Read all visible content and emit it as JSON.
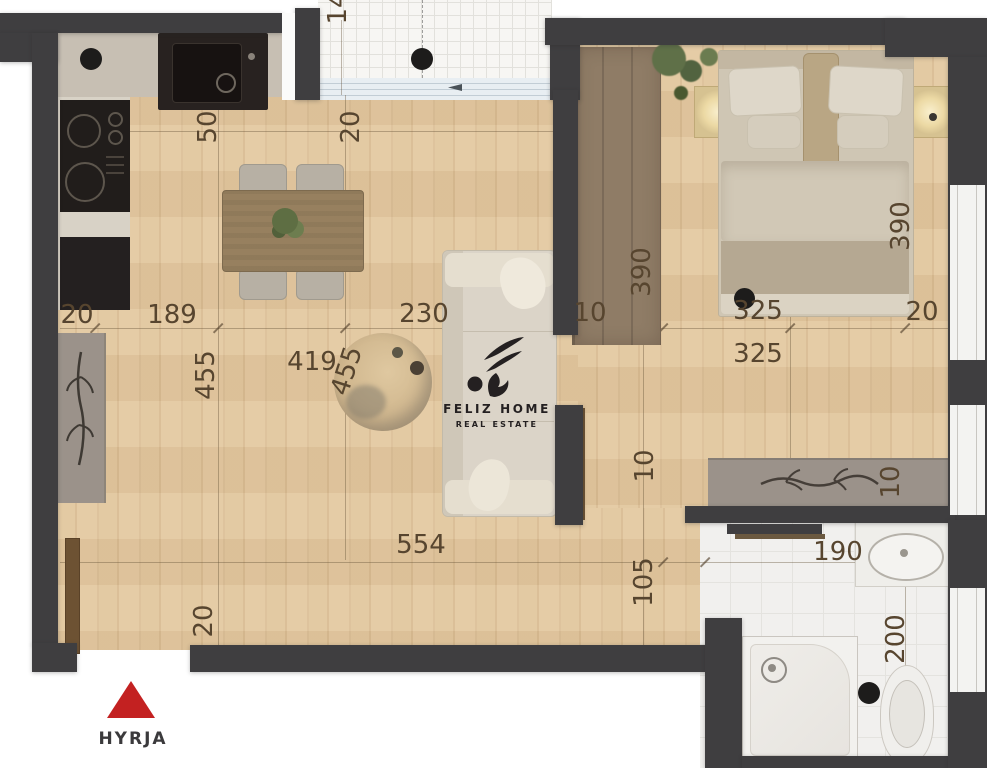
{
  "branding": {
    "name": "FELIZ HOME",
    "subtitle": "REAL ESTATE"
  },
  "entrance": {
    "label": "HYRJA"
  },
  "dims": {
    "d1": "20",
    "d2": "189",
    "d3": "230",
    "d4": "10",
    "d5": "325",
    "d6": "20",
    "d7": "325",
    "d8": "50",
    "d9": "20",
    "d10": "455",
    "d11": "419",
    "d12": "455",
    "d13": "390",
    "d14": "390",
    "d15": "10",
    "d16": "105",
    "d17": "554",
    "d18": "20",
    "d19": "10",
    "d20": "190",
    "d21": "200",
    "d22": "14"
  },
  "colors": {
    "wall": "#3f3e40",
    "floor": "#e2c79e",
    "floor2": "#d9bc92",
    "dim": "#57452f",
    "counter": "#c7bfb3",
    "dark_cab": "#242020",
    "wood_mid": "#97805f",
    "gray_furn": "#9b928a",
    "tile": "#f1f0ee",
    "balcony_tile": "#f7f6f3",
    "glass": "#e8eef2",
    "wardrobe": "#8f7c66",
    "bed": "#cfc6b4",
    "sofa": "#dbd4c8",
    "logo": "#242021",
    "red": "#c32121",
    "hyrja_text": "#3b3a3c"
  }
}
